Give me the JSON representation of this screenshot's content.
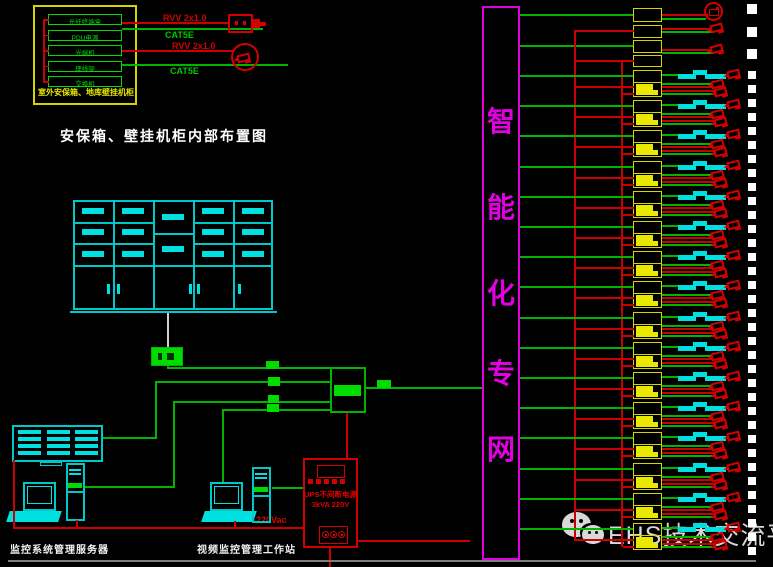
{
  "title": "安保箱、壁挂机柜内部布置图",
  "cabinet": {
    "outer_label": "室外安保箱、地库壁挂机柜",
    "modules": [
      "光纤终端盒",
      "PDU电源",
      "光端机",
      "理线架",
      "交换机"
    ],
    "wire_labels": [
      {
        "text": "RVV 2x1.0",
        "color": "#d40000",
        "x": 163,
        "y": 13
      },
      {
        "text": "CAT5E",
        "color": "#00c800",
        "x": 165,
        "y": 30
      },
      {
        "text": "RVV 2x1.0",
        "color": "#d40000",
        "x": 172,
        "y": 41
      },
      {
        "text": "CAT5E",
        "color": "#00c800",
        "x": 170,
        "y": 66
      }
    ]
  },
  "network_column": {
    "text": "智能化专网"
  },
  "floor_labels": {
    "server": "监控系统管理服务器",
    "workstation": "视频监控管理工作站"
  },
  "power": {
    "voltage_label": "220Vac",
    "ups_line1": "UPS不间断电源",
    "ups_line2": "3kVA 220V"
  },
  "watermark": {
    "text": "EHS技术交流平台",
    "brand_icon": "wechat-icon"
  },
  "right_panel": {
    "top_single_camera_units": 3,
    "bracket_units": 16,
    "cameras_per_bracket_unit": 3
  },
  "colors": {
    "green": "#00b400",
    "green_fill": "#00dc00",
    "red": "#cc0000",
    "yellow": "#d4d400",
    "yellow_fill": "#e8e800",
    "cyan": "#00c8c8",
    "cyan_fill": "#00e0e0",
    "magenta": "#e000e0",
    "white": "#ffffff",
    "gray": "#7d7d7d",
    "watermark_gray": "#d8d8d8"
  }
}
